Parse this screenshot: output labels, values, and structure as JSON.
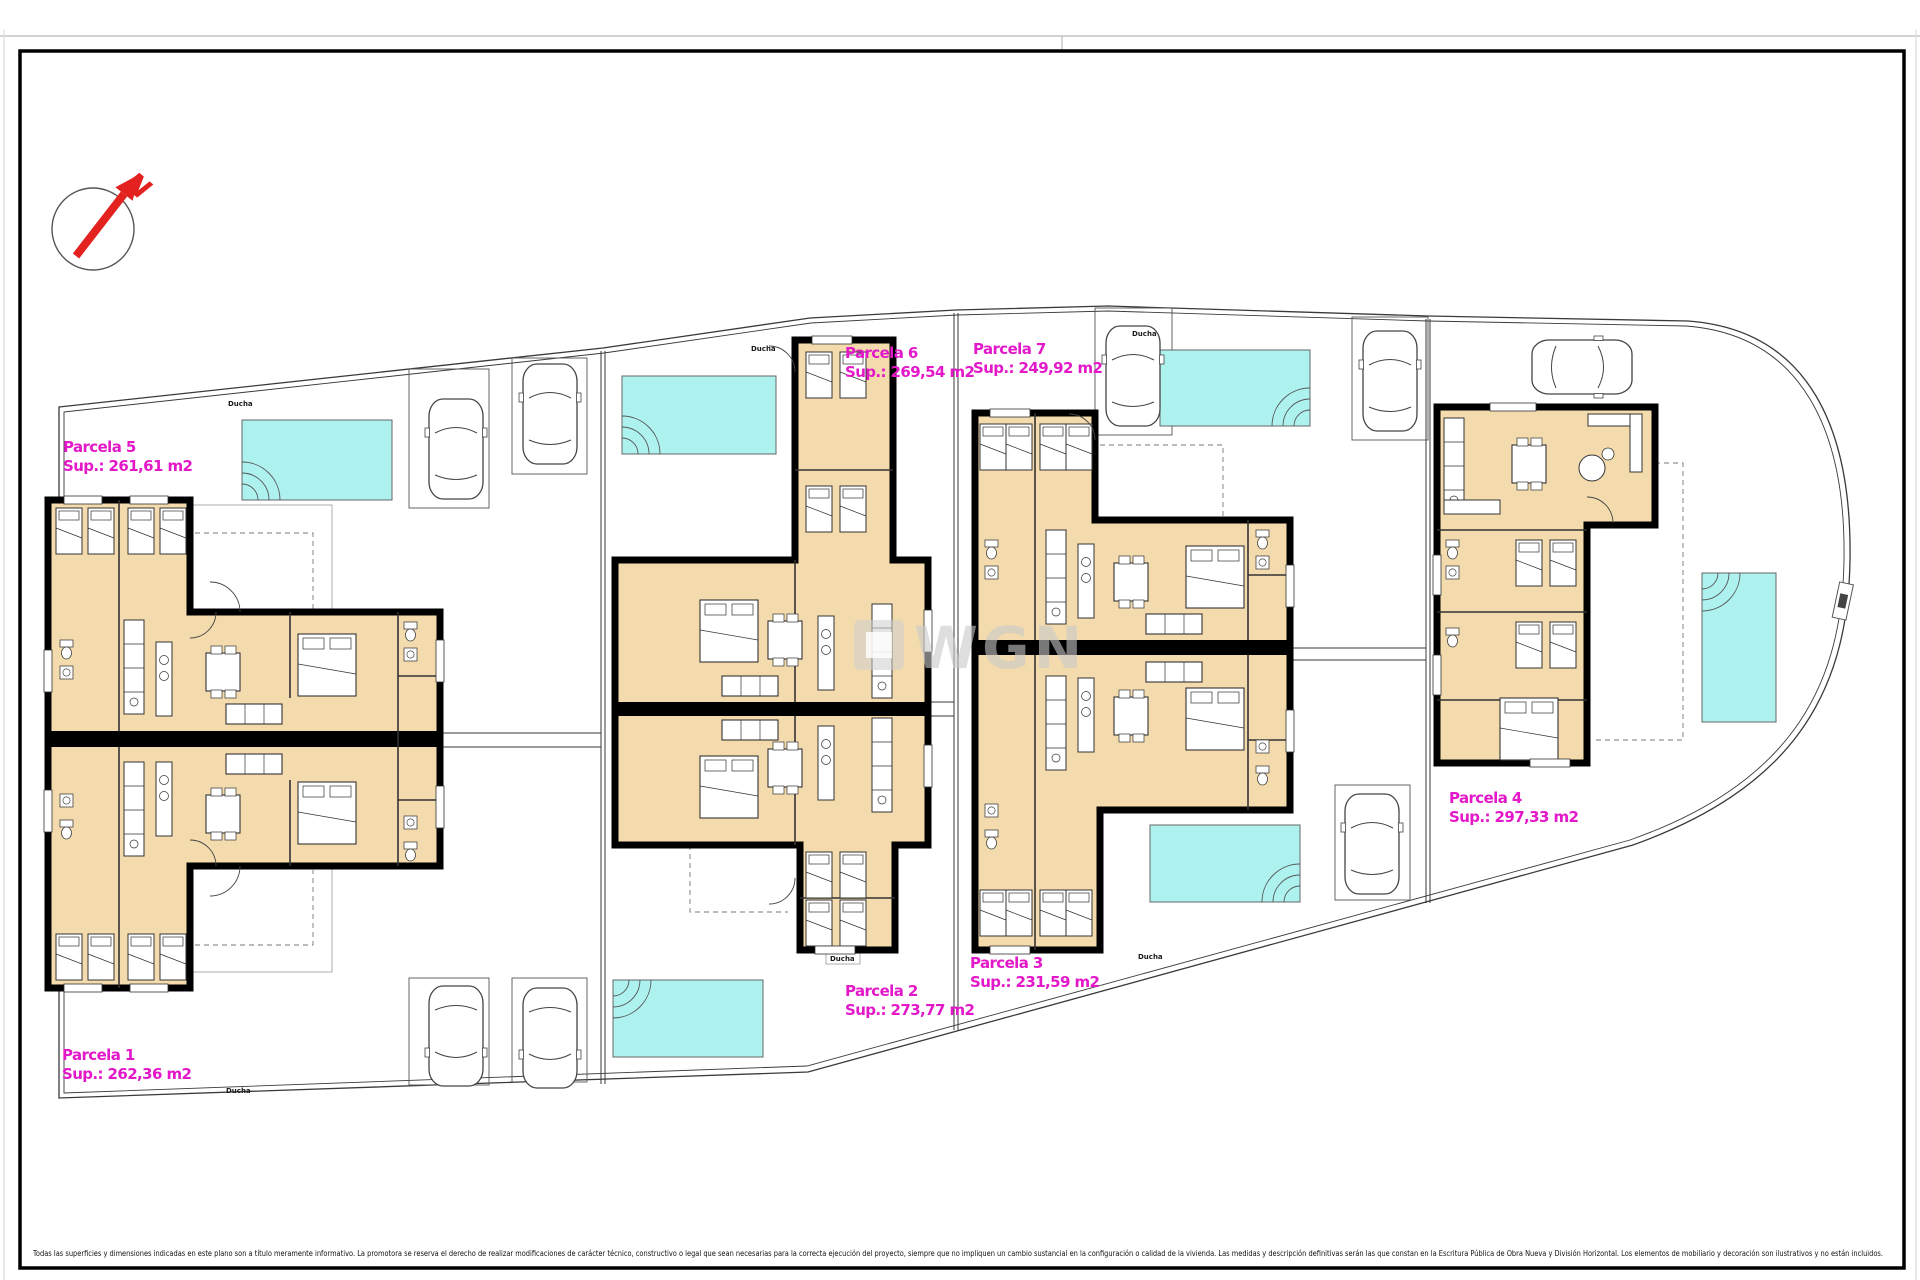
{
  "page": {
    "background": "#ffffff"
  },
  "colors": {
    "wall": "#000000",
    "room_fill": "#f4dbae",
    "pool_fill": "#aef2ef",
    "parcel_label": "#e318c9",
    "compass_red": "#e32220",
    "watermark_gray": "#c9c9c9"
  },
  "compass": {
    "letter": "N"
  },
  "watermark": {
    "text": "WGN"
  },
  "labels": {
    "ducha": "Ducha"
  },
  "parcels": [
    {
      "name": "Parcela 1",
      "sup": "Sup.: 262,36 m2"
    },
    {
      "name": "Parcela 2",
      "sup": "Sup.: 273,77 m2"
    },
    {
      "name": "Parcela 3",
      "sup": "Sup.: 231,59 m2"
    },
    {
      "name": "Parcela 4",
      "sup": "Sup.: 297,33 m2"
    },
    {
      "name": "Parcela 5",
      "sup": "Sup.: 261,61 m2"
    },
    {
      "name": "Parcela 6",
      "sup": "Sup.: 269,54 m2"
    },
    {
      "name": "Parcela 7",
      "sup": "Sup.: 249,92 m2"
    }
  ],
  "footer": {
    "disclaimer": "Todas las superficies y dimensiones indicadas en este plano son a título meramente informativo. La promotora se reserva el derecho de realizar modificaciones de carácter técnico, constructivo o legal que sean necesarias para la correcta ejecución del proyecto, siempre que no impliquen un cambio sustancial en la configuración o calidad de la vivienda. Las medidas y descripción definitivas serán las que constan en la Escritura Pública de Obra Nueva y División Horizontal. Los elementos de mobiliario y decoración son ilustrativos y no están incluidos."
  }
}
